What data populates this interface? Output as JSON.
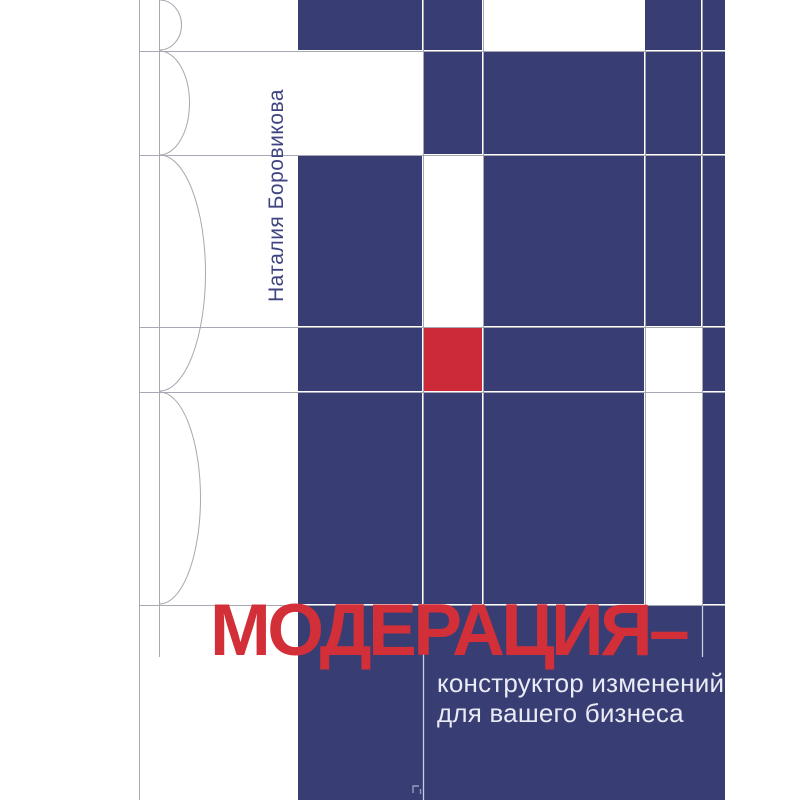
{
  "cover": {
    "author": "Наталия Боровикова",
    "title": "МОДЕРАЦИЯ–",
    "subtitle": {
      "line1": "конструктор изменений",
      "line2": "для вашего бизнеса"
    },
    "colors": {
      "block_blue": "#383d73",
      "accent_red_square": "#cc2a39",
      "title_red": "#d32f38",
      "subtitle_text": "#e9ebf5",
      "author_text": "#3f4480",
      "grid_line_gray": "#a6a8b3",
      "grid_line_on_blue": "#c9cdde"
    }
  }
}
